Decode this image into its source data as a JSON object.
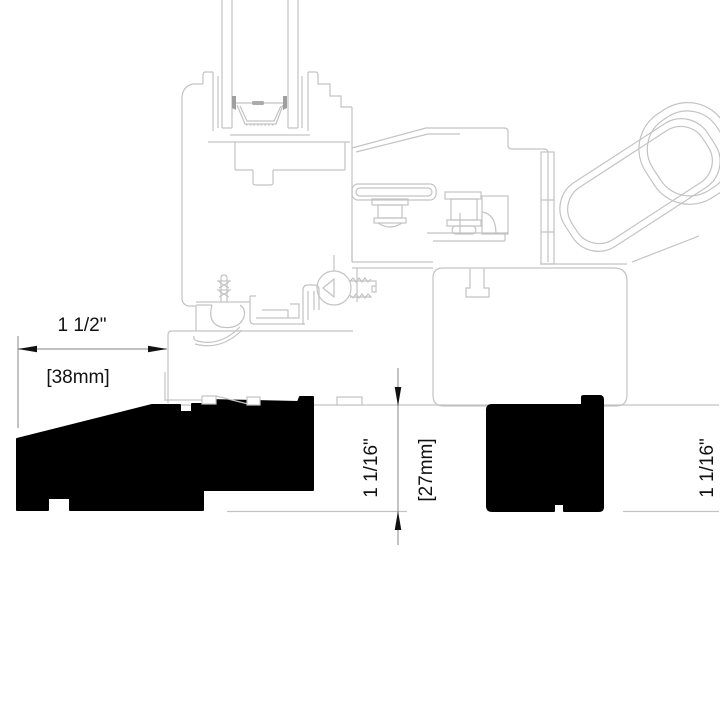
{
  "page": {
    "background_color": "#ffffff",
    "canvas_width": 720,
    "canvas_height": 720
  },
  "drawing": {
    "type": "window-sill-cross-section-technical-drawing",
    "line_color": "#c3c3c3",
    "detail_fill_color": "#9f9f9f",
    "profile_fill_color": "#000000",
    "dimension_line_color": "#9b9b9b",
    "text_color": "#111111"
  },
  "dimensions": {
    "width": {
      "inches": "1 1/2\"",
      "millimeters": "[38mm]"
    },
    "height_left": {
      "inches": "1 1/16\"",
      "millimeters": "[27mm]"
    },
    "height_right": {
      "inches": "1 1/16\""
    }
  }
}
